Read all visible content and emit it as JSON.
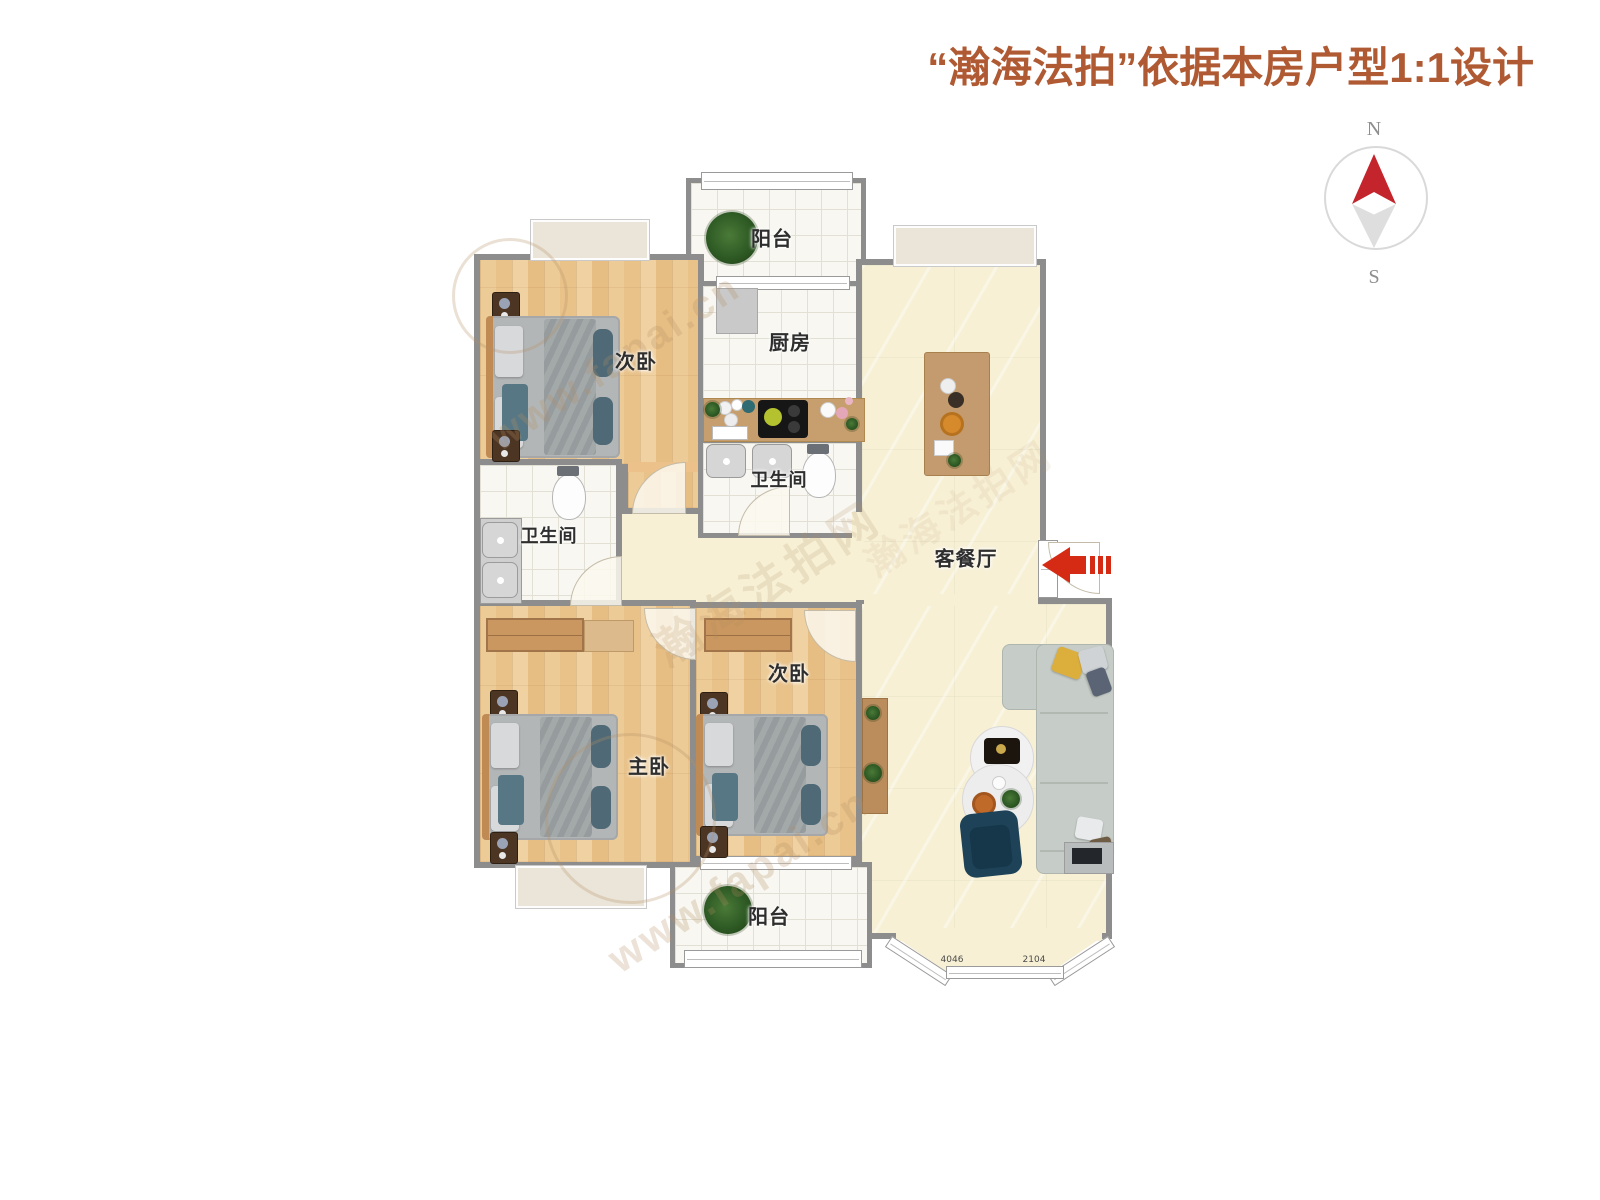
{
  "title": {
    "text": "“瀚海法拍”依据本房户型1:1设计",
    "color": "#b05a33"
  },
  "compass": {
    "north_label": "N",
    "south_label": "S"
  },
  "rooms": {
    "balcony_top": {
      "label": "阳台"
    },
    "bedroom_top_left": {
      "label": "次卧"
    },
    "kitchen": {
      "label": "厨房"
    },
    "bathroom_small": {
      "label": "卫生间"
    },
    "bathroom_main": {
      "label": "卫生间"
    },
    "living_dining": {
      "label": "客餐厅"
    },
    "master_bedroom": {
      "label": "主卧"
    },
    "bedroom_second": {
      "label": "次卧"
    },
    "balcony_bottom": {
      "label": "阳台"
    }
  },
  "annotations": {
    "bay_dim_left": "4046",
    "bay_dim_right": "2104"
  },
  "watermark": {
    "brand": "瀚海法拍网",
    "url": "www.fapai.cn"
  },
  "palette": {
    "wall": "#8d8d8d",
    "wood_floor": "#ecc28a",
    "tile_floor": "#f8f7f1",
    "living_floor": "#f7f0d5",
    "entrance_red": "#d52b14",
    "compass_red": "#c4242b",
    "title_color": "#b05a33"
  }
}
